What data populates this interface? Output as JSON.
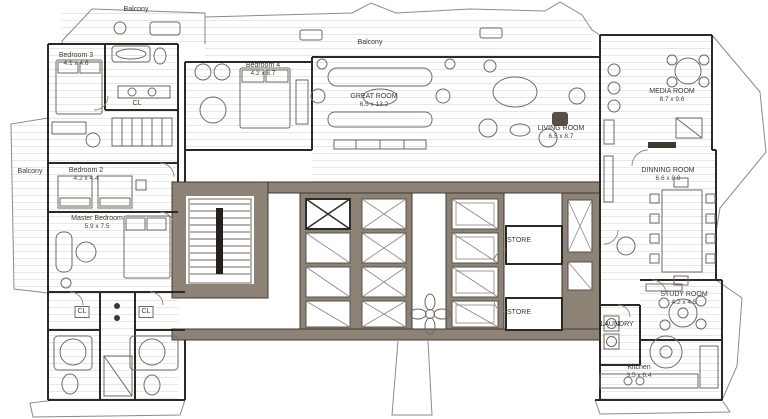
{
  "colors": {
    "wall_line": "#2c2925",
    "core_fill": "#8d8276",
    "sketch_line": "#8a8a8a",
    "furniture_line": "#6f6a61",
    "hatch_line": "#e6e4e0",
    "text": "#3b3833",
    "background": "#ffffff"
  },
  "balconies": {
    "top_left": {
      "label": "Balcony"
    },
    "top_center": {
      "label": "Balcony"
    },
    "left": {
      "label": "Balcony"
    }
  },
  "rooms": {
    "bedroom3": {
      "label": "Bedroom 3",
      "dims": "4.1 x 4.6"
    },
    "bedroom4": {
      "label": "Bedroom 4",
      "dims": "4.2 x 8.7"
    },
    "great_room": {
      "label": "GREAT ROOM",
      "dims": "6.5 x 13.2"
    },
    "living_room": {
      "label": "LIVING ROOM",
      "dims": "6.5 x 8.7"
    },
    "media_room": {
      "label": "MEDIA ROOM",
      "dims": "8.7 x 9.6"
    },
    "dinning_room": {
      "label": "DINNING ROOM",
      "dims": "6.6 x 8.8"
    },
    "study_room": {
      "label": "STUDY ROOM",
      "dims": "4.2 x 4.5"
    },
    "laundry": {
      "label": "LAUNDRY"
    },
    "kitchen": {
      "label": "Kitchen",
      "dims": "3.5 x 6.4"
    },
    "master_bedroom": {
      "label": "Master Bedroom",
      "dims": "5.9 x 7.5"
    },
    "bedroom2": {
      "label": "Bedroom 2",
      "dims": "4.2 x 4.4"
    },
    "closet_top": {
      "label": "CL"
    },
    "closet_left": {
      "label": "CL"
    },
    "closet_right": {
      "label": "CL"
    },
    "store_top": {
      "label": "STORE"
    },
    "store_bottom": {
      "label": "STORE"
    }
  }
}
